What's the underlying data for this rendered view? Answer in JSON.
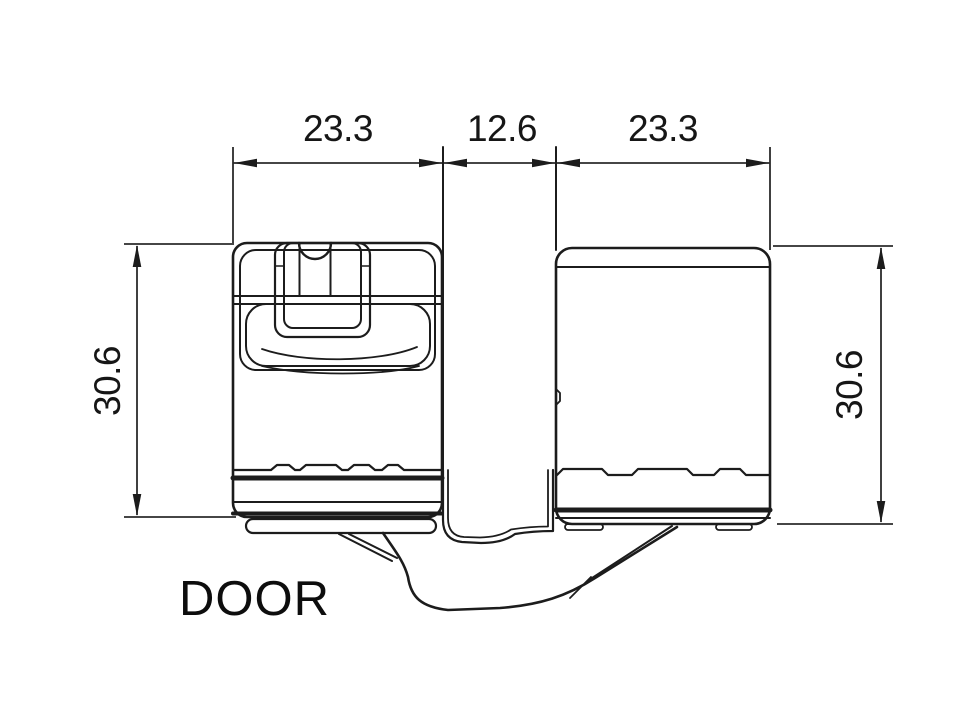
{
  "drawing": {
    "type_label": "DOOR",
    "dimensions": {
      "top_left_width": "23.3",
      "top_center_gap": "12.6",
      "top_right_width": "23.3",
      "left_height": "30.6",
      "right_height": "30.6"
    },
    "colors": {
      "line": "#1c1c1c",
      "dimension_line": "#2b2b2b",
      "text": "#111111",
      "background": "#ffffff"
    }
  }
}
